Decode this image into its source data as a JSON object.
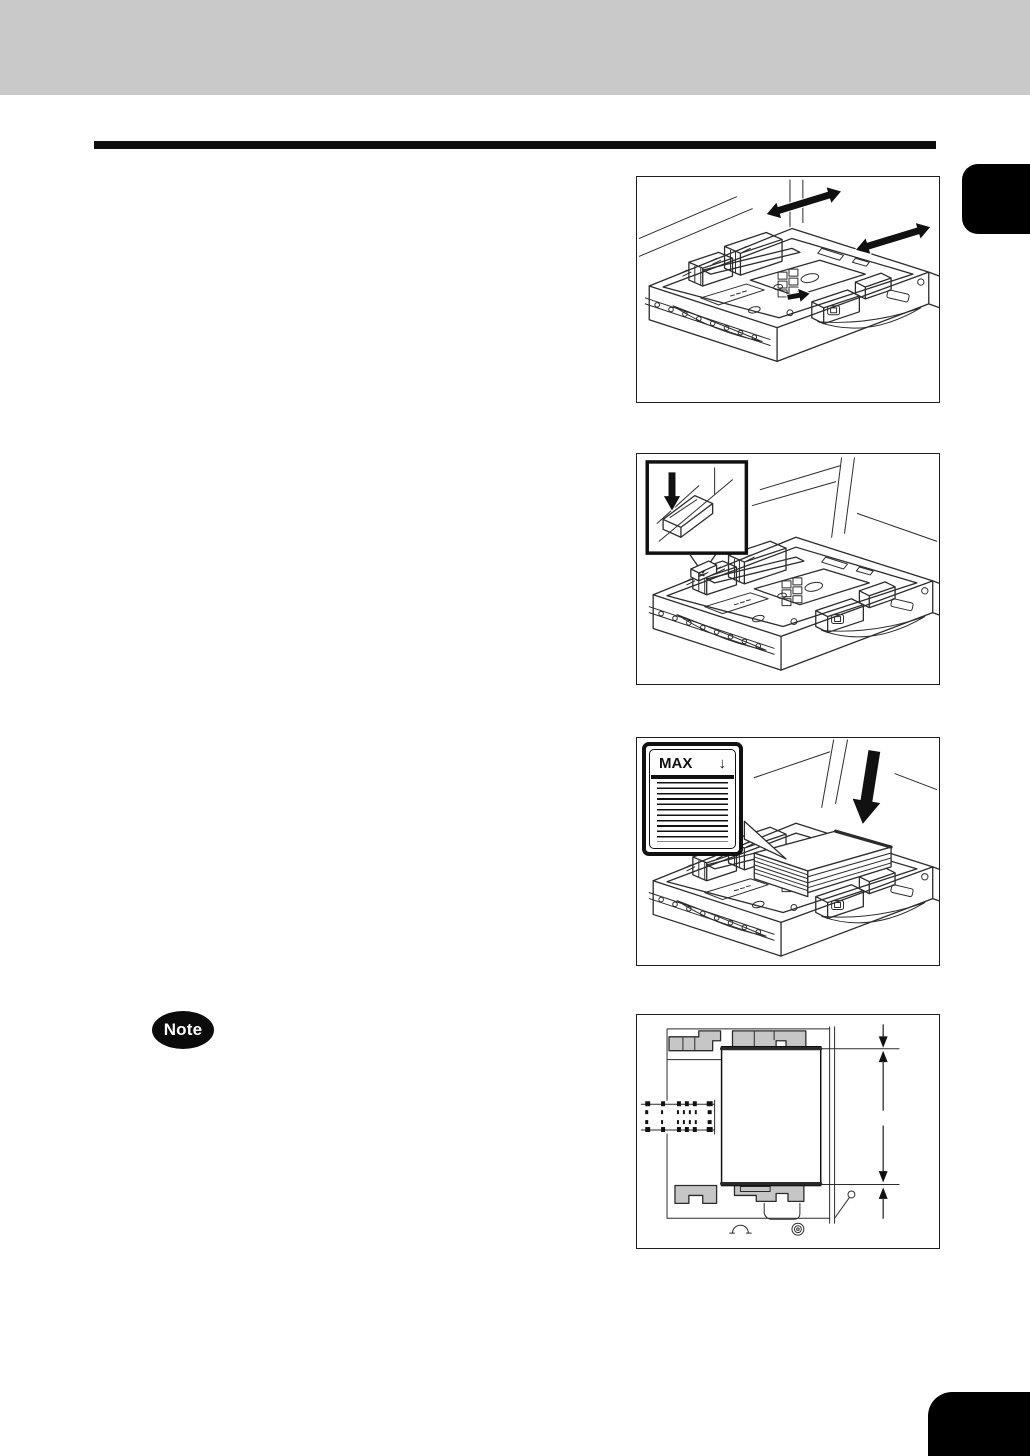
{
  "page": {
    "background_color": "#ffffff",
    "header_bar_color": "#c9c9c9",
    "rule_color": "#0d0d0d",
    "tab_color": "#000000",
    "corner_mark_color": "#000000",
    "line_art_color": "#2b2b2b",
    "guide_fill_color": "#c6c6c6"
  },
  "note": {
    "label": "Note"
  },
  "figures": [
    {
      "id": "adjust-side-guides",
      "description": "Paper cassette with side guides; double-headed arrows show guide sliding directions"
    },
    {
      "id": "press-plate-lever",
      "description": "Cassette with inset detail of a lever being pressed down (black down arrow)"
    },
    {
      "id": "load-paper",
      "description": "Stack of paper loaded into cassette below the MAX level line",
      "inset": {
        "label": "MAX",
        "arrow": "↓"
      }
    },
    {
      "id": "paper-position-top-view",
      "description": "Top view of paper set against gray guides with clearance dimension arrows"
    }
  ]
}
